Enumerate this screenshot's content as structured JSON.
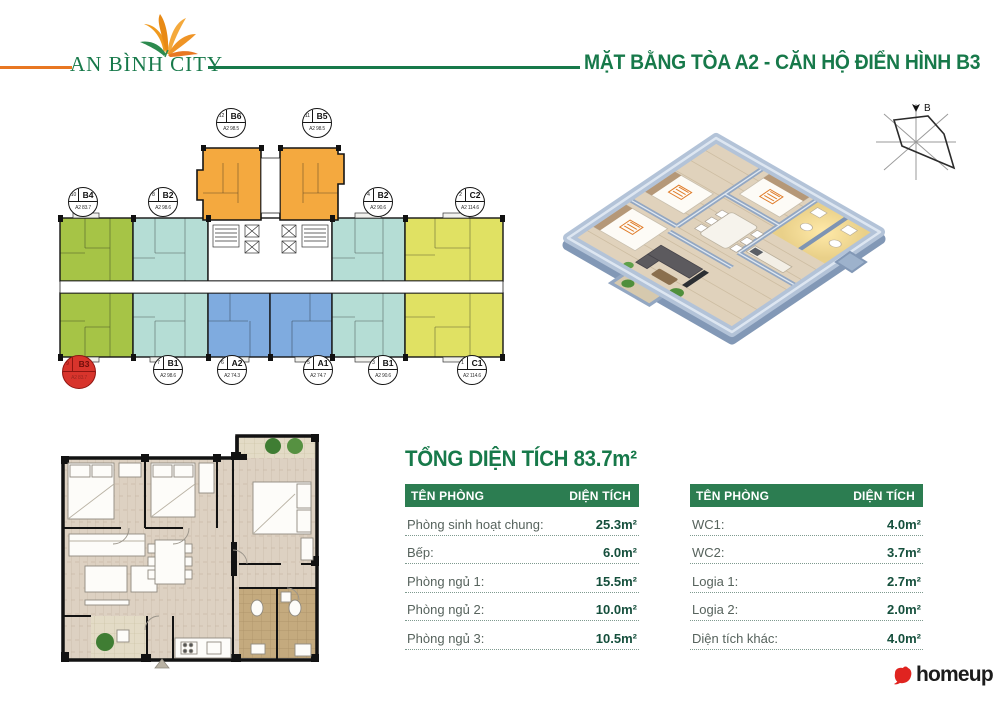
{
  "header": {
    "logo_text": "AN BÌNH CITY",
    "title": "MẶT BẰNG TÒA A2 - CĂN HỘ ĐIỂN HÌNH B3"
  },
  "colors": {
    "brand_green": "#17794a",
    "brand_orange": "#e87722",
    "table_header_bg": "#2c7d51",
    "highlight_red": "#d8342c",
    "unit_green": "#a6c446",
    "unit_teal": "#b5ddd5",
    "unit_blue": "#7fabdf",
    "unit_yellow": "#e0e163",
    "unit_orange": "#f4a93f"
  },
  "tower_plan": {
    "units_top": [
      {
        "no": "12",
        "code": "B6",
        "area": "A2 98.5"
      },
      {
        "no": "11",
        "code": "B5",
        "area": "A2 98.5"
      }
    ],
    "units_upper": [
      {
        "no": "10",
        "code": "B4",
        "area": "A2 83.7"
      },
      {
        "no": "8",
        "code": "B2",
        "area": "A2 98.6"
      },
      {
        "no": "4",
        "code": "B2",
        "area": "A2 90.6"
      },
      {
        "no": "2",
        "code": "C2",
        "area": "A2 114.6"
      }
    ],
    "units_lower": [
      {
        "no": "9",
        "code": "B3",
        "area": "A2 83.7"
      },
      {
        "no": "7",
        "code": "B1",
        "area": "A2 98.6"
      },
      {
        "no": "6",
        "code": "A2",
        "area": "A2 74.3"
      },
      {
        "no": "5",
        "code": "A1",
        "area": "A2 74.7"
      },
      {
        "no": "3",
        "code": "B1",
        "area": "A2 90.6"
      },
      {
        "no": "1",
        "code": "C1",
        "area": "A2 114.6"
      }
    ]
  },
  "compass": {
    "north_label": "B"
  },
  "area_summary": {
    "title": "TỔNG DIỆN TÍCH 83.7m²"
  },
  "tables": [
    {
      "header": {
        "name": "TÊN PHÒNG",
        "area": "DIỆN TÍCH"
      },
      "rows": [
        {
          "name": "Phòng sinh hoạt chung:",
          "area": "25.3m²"
        },
        {
          "name": "Bếp:",
          "area": "6.0m²"
        },
        {
          "name": "Phòng ngủ 1:",
          "area": "15.5m²"
        },
        {
          "name": "Phòng ngủ 2:",
          "area": "10.0m²"
        },
        {
          "name": "Phòng ngủ 3:",
          "area": "10.5m²"
        }
      ]
    },
    {
      "header": {
        "name": "TÊN PHÒNG",
        "area": "DIỆN TÍCH"
      },
      "rows": [
        {
          "name": "WC1:",
          "area": "4.0m²"
        },
        {
          "name": "WC2:",
          "area": "3.7m²"
        },
        {
          "name": "Logia 1:",
          "area": "2.7m²"
        },
        {
          "name": "Logia 2:",
          "area": "2.0m²"
        },
        {
          "name": "Diện tích khác:",
          "area": "4.0m²"
        }
      ]
    }
  ],
  "footer": {
    "brand": "homeup"
  }
}
